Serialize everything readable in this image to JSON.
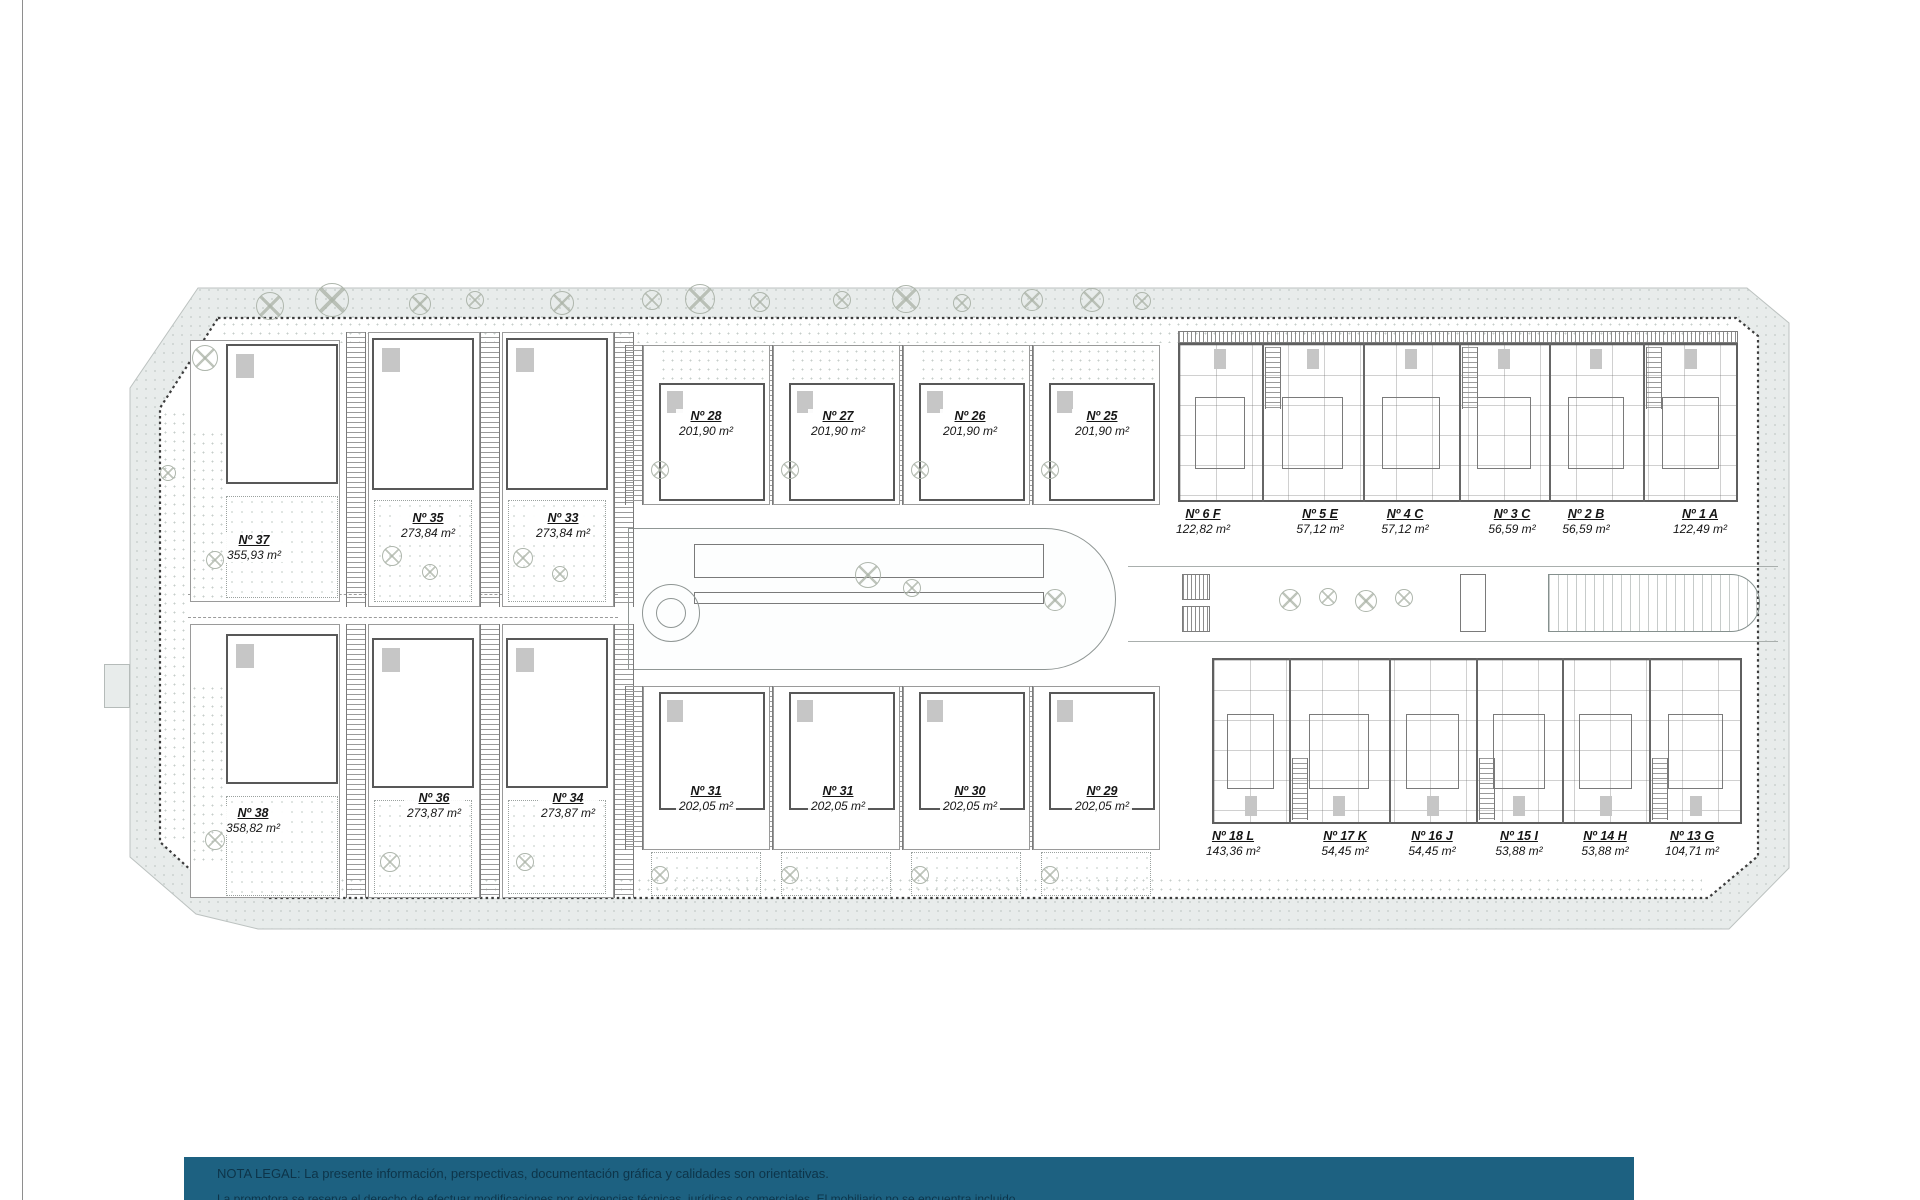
{
  "plan": {
    "colors": {
      "street_band": "#e8eceb",
      "boundary_line": "#3c3c3c",
      "walls": "#585858"
    },
    "units": [
      {
        "label": "Nº 37",
        "area": "355,93 m²",
        "cx": 254,
        "ty": 533
      },
      {
        "label": "Nº 35",
        "area": "273,84 m²",
        "cx": 428,
        "ty": 511
      },
      {
        "label": "Nº 33",
        "area": "273,84 m²",
        "cx": 563,
        "ty": 511
      },
      {
        "label": "Nº 28",
        "area": "201,90 m²",
        "cx": 706,
        "ty": 409
      },
      {
        "label": "Nº 27",
        "area": "201,90 m²",
        "cx": 838,
        "ty": 409
      },
      {
        "label": "Nº 26",
        "area": "201,90 m²",
        "cx": 970,
        "ty": 409
      },
      {
        "label": "Nº 25",
        "area": "201,90 m²",
        "cx": 1102,
        "ty": 409
      },
      {
        "label": "Nº 6 F",
        "area": "122,82 m²",
        "cx": 1203,
        "ty": 507
      },
      {
        "label": "Nº 5 E",
        "area": "57,12 m²",
        "cx": 1320,
        "ty": 507
      },
      {
        "label": "Nº 4 C",
        "area": "57,12 m²",
        "cx": 1405,
        "ty": 507
      },
      {
        "label": "Nº 3 C",
        "area": "56,59 m²",
        "cx": 1512,
        "ty": 507
      },
      {
        "label": "Nº 2 B",
        "area": "56,59 m²",
        "cx": 1586,
        "ty": 507
      },
      {
        "label": "Nº 1 A",
        "area": "122,49 m²",
        "cx": 1700,
        "ty": 507
      },
      {
        "label": "Nº 38",
        "area": "358,82 m²",
        "cx": 253,
        "ty": 806
      },
      {
        "label": "Nº 36",
        "area": "273,87 m²",
        "cx": 434,
        "ty": 791
      },
      {
        "label": "Nº 34",
        "area": "273,87 m²",
        "cx": 568,
        "ty": 791
      },
      {
        "label": "Nº 31",
        "area": "202,05 m²",
        "cx": 706,
        "ty": 784
      },
      {
        "label": "Nº 31",
        "area": "202,05 m²",
        "cx": 838,
        "ty": 784
      },
      {
        "label": "Nº 30",
        "area": "202,05 m²",
        "cx": 970,
        "ty": 784
      },
      {
        "label": "Nº 29",
        "area": "202,05 m²",
        "cx": 1102,
        "ty": 784
      },
      {
        "label": "Nº 18 L",
        "area": "143,36 m²",
        "cx": 1233,
        "ty": 829
      },
      {
        "label": "Nº 17 K",
        "area": "54,45 m²",
        "cx": 1345,
        "ty": 829
      },
      {
        "label": "Nº 16 J",
        "area": "54,45 m²",
        "cx": 1432,
        "ty": 829
      },
      {
        "label": "Nº 15 I",
        "area": "53,88 m²",
        "cx": 1519,
        "ty": 829
      },
      {
        "label": "Nº 14 H",
        "area": "53,88 m²",
        "cx": 1605,
        "ty": 829
      },
      {
        "label": "Nº 13 G",
        "area": "104,71 m²",
        "cx": 1692,
        "ty": 829
      }
    ]
  },
  "legal_note": {
    "bar_color": "#1d6181",
    "text_color": "#0d3449",
    "line1": "NOTA LEGAL: La presente información, perspectivas, documentación gráfica y calidades son orientativas.",
    "line2_partial": "La promotora se reserva el derecho de efectuar modificaciones por exigencias técnicas, jurídicas o comerciales. El mobiliario no se encuentra incluido."
  }
}
